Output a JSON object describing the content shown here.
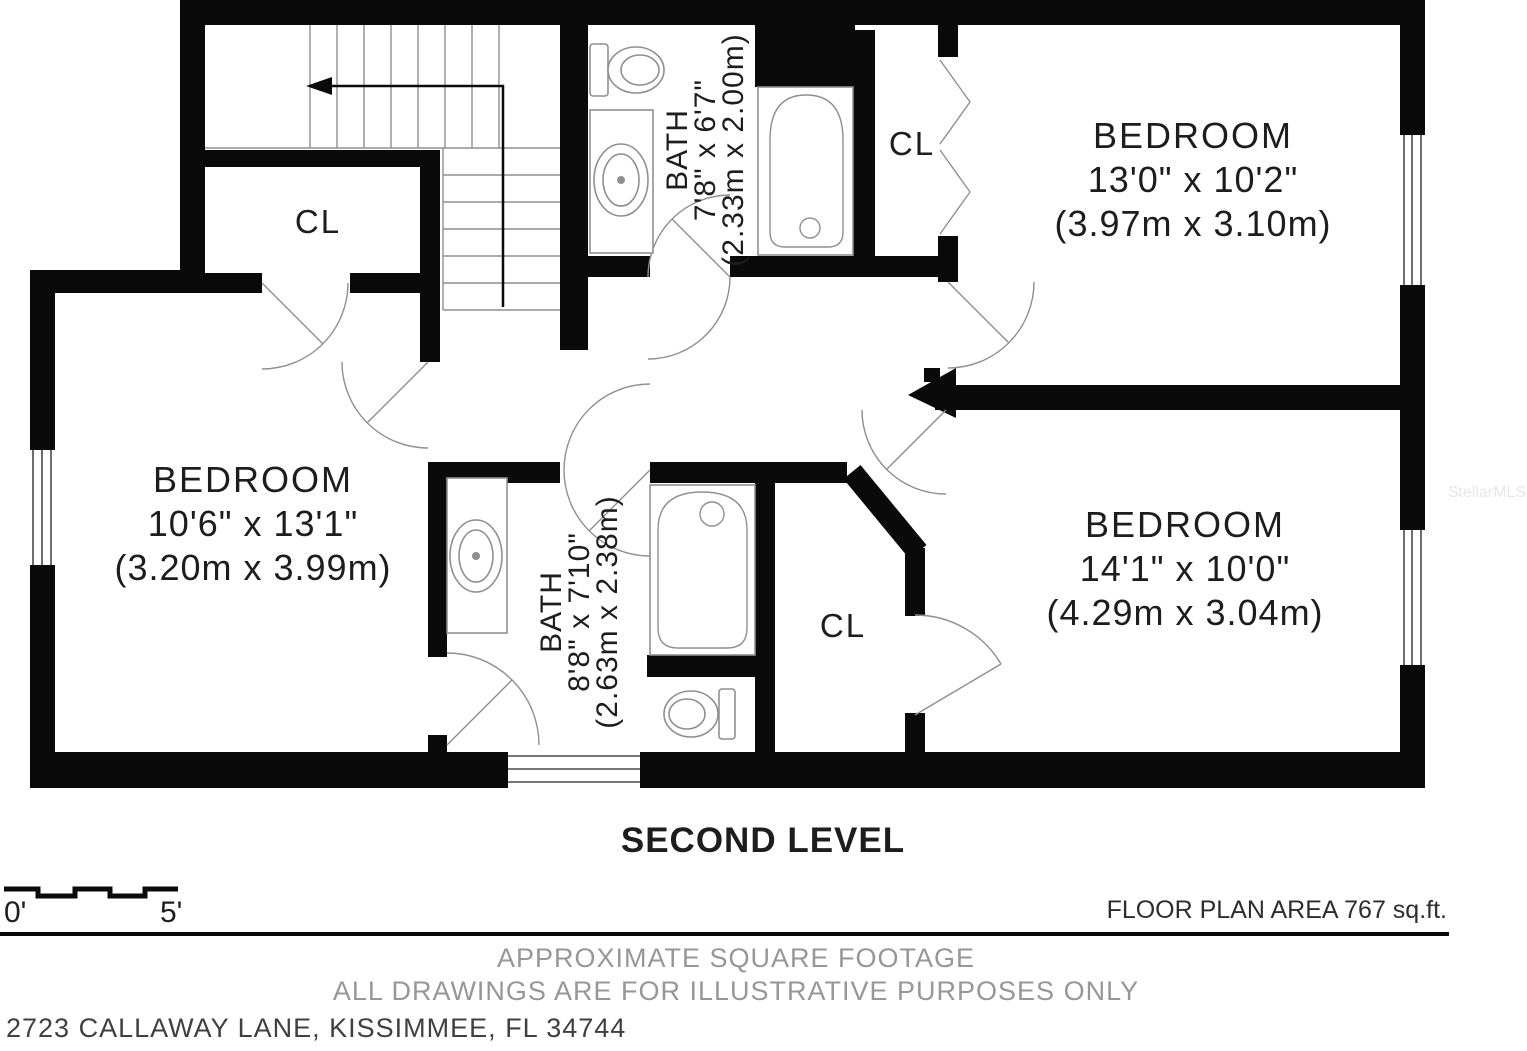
{
  "floor_plan": {
    "level_title": "SECOND LEVEL",
    "rooms": {
      "bedroom_top_right": {
        "name": "BEDROOM",
        "dim_imperial": "13'0\" x 10'2\"",
        "dim_metric": "(3.97m x 3.10m)"
      },
      "bedroom_left": {
        "name": "BEDROOM",
        "dim_imperial": "10'6\" x 13'1\"",
        "dim_metric": "(3.20m x 3.99m)"
      },
      "bedroom_bottom_right": {
        "name": "BEDROOM",
        "dim_imperial": "14'1\" x 10'0\"",
        "dim_metric": "(4.29m x 3.04m)"
      },
      "bath_top": {
        "name": "BATH",
        "dim_imperial": "7'8\" x 6'7\"",
        "dim_metric": "(2.33m x 2.00m)"
      },
      "bath_bottom": {
        "name": "BATH",
        "dim_imperial": "8'8\" x 7'10\"",
        "dim_metric": "(2.63m x 2.38m)"
      },
      "closet_top_left": {
        "label": "CL"
      },
      "closet_top_right": {
        "label": "CL"
      },
      "closet_bottom": {
        "label": "CL"
      }
    },
    "scale_bar": {
      "start_label": "0'",
      "end_label": "5'"
    },
    "area_label": "FLOOR PLAN AREA 767 sq.ft.",
    "footnotes": {
      "line1": "APPROXIMATE SQUARE FOOTAGE",
      "line2": "ALL DRAWINGS ARE FOR ILLUSTRATIVE PURPOSES ONLY"
    },
    "address": "2723 CALLAWAY LANE, KISSIMMEE, FL 34744",
    "watermark": "StellarMLS",
    "colors": {
      "wall": "#0a0a0a",
      "fixture_line": "#8f8f8f",
      "text_dark": "#1d1d1d",
      "text_muted": "#979797"
    }
  }
}
